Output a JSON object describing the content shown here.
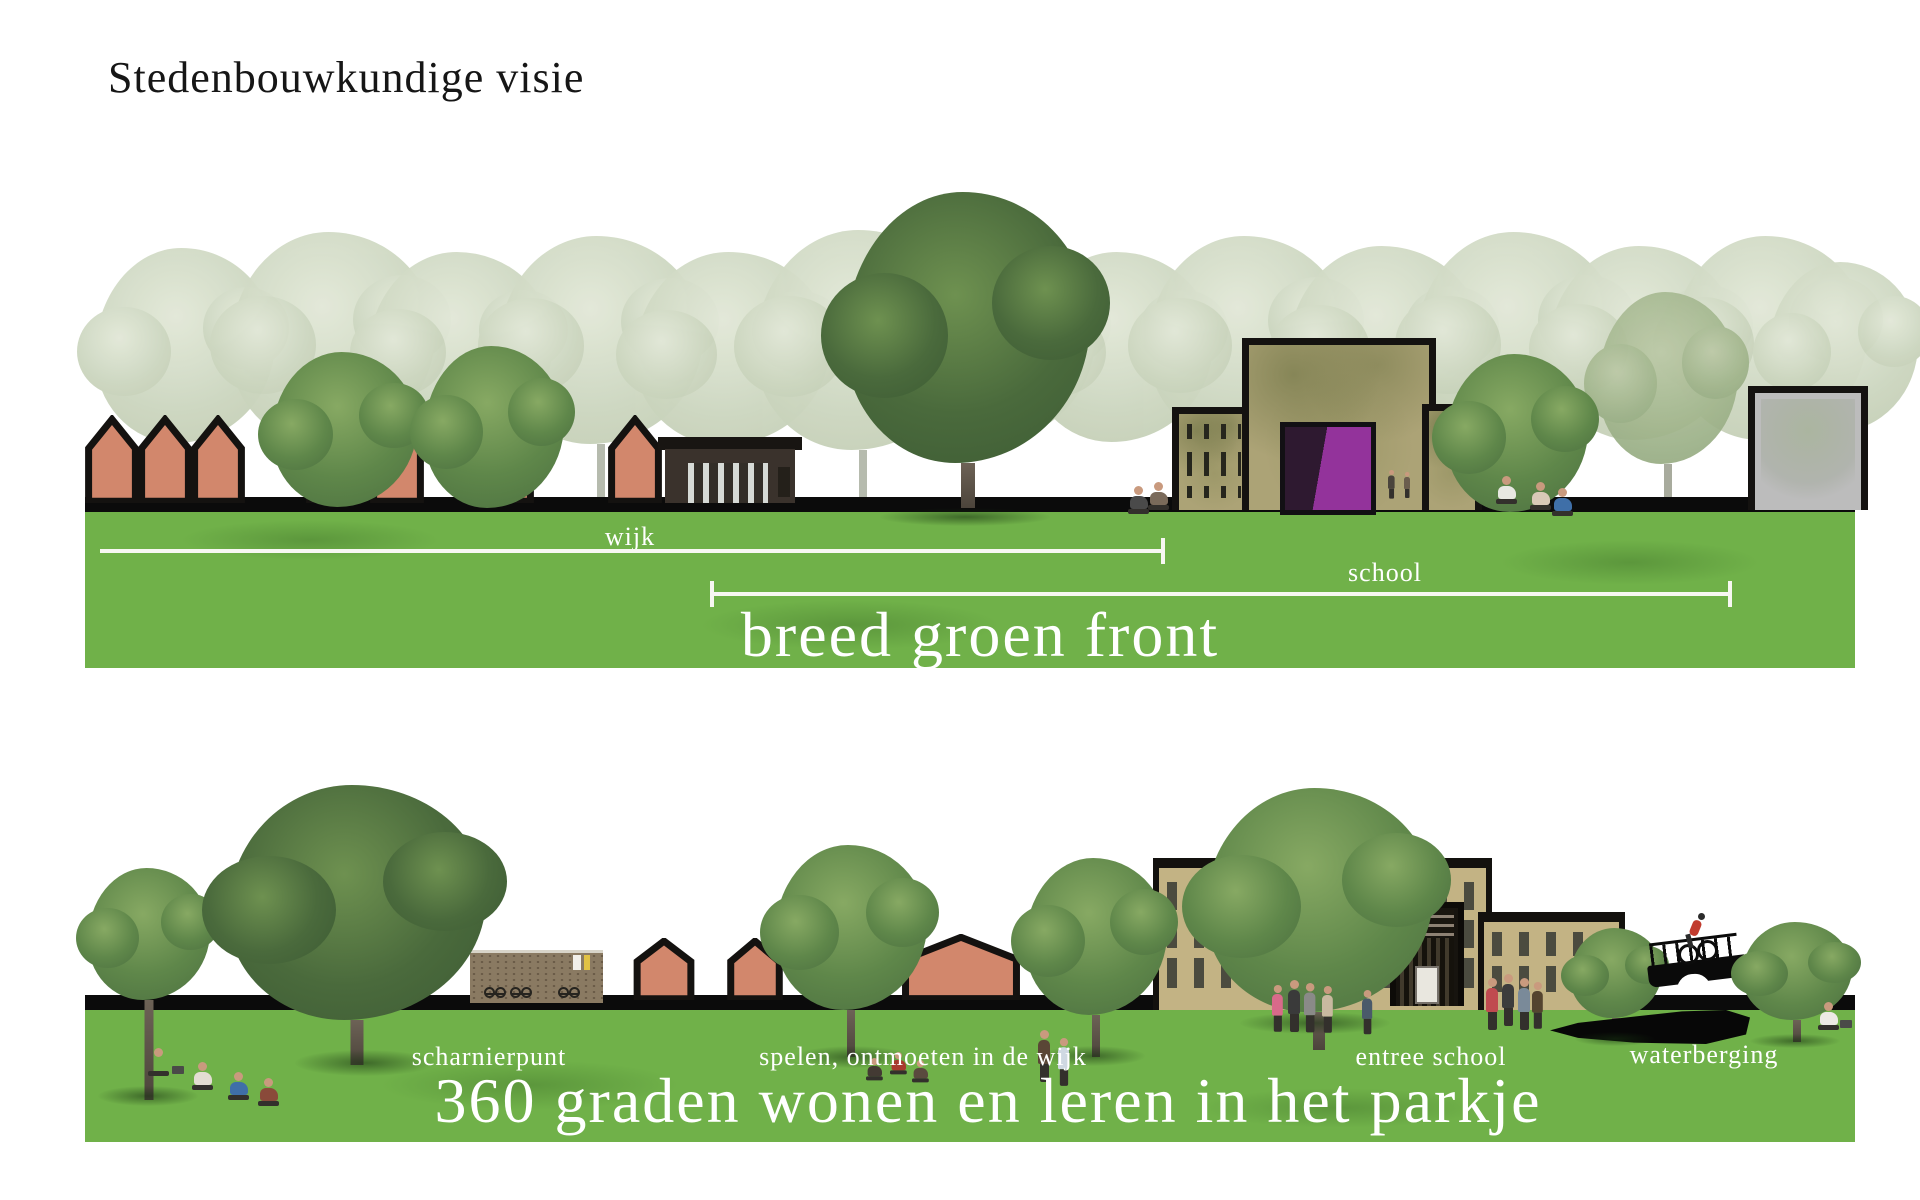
{
  "title": "Stedenbouwkundige visie",
  "upper_section": {
    "dimension_labels": {
      "wijk": "wijk",
      "school": "school"
    },
    "caption": "breed groen front"
  },
  "lower_section": {
    "labels": {
      "scharnierpunt": "scharnierpunt",
      "spelen_ontmoeten": "spelen, ontmoeten in de wijk",
      "entree_school": "entree school",
      "waterberging": "waterberging"
    },
    "caption": "360 graden wonen en leren in het parkje"
  },
  "colors": {
    "green_band": "#70b149",
    "house_salmon": "#d2876c",
    "school_khaki_upper": "#aca376",
    "school_tan_lower": "#c3b384",
    "entrance_purple": "#93339b",
    "label_white": "#ffffff",
    "title_black": "#161616"
  }
}
